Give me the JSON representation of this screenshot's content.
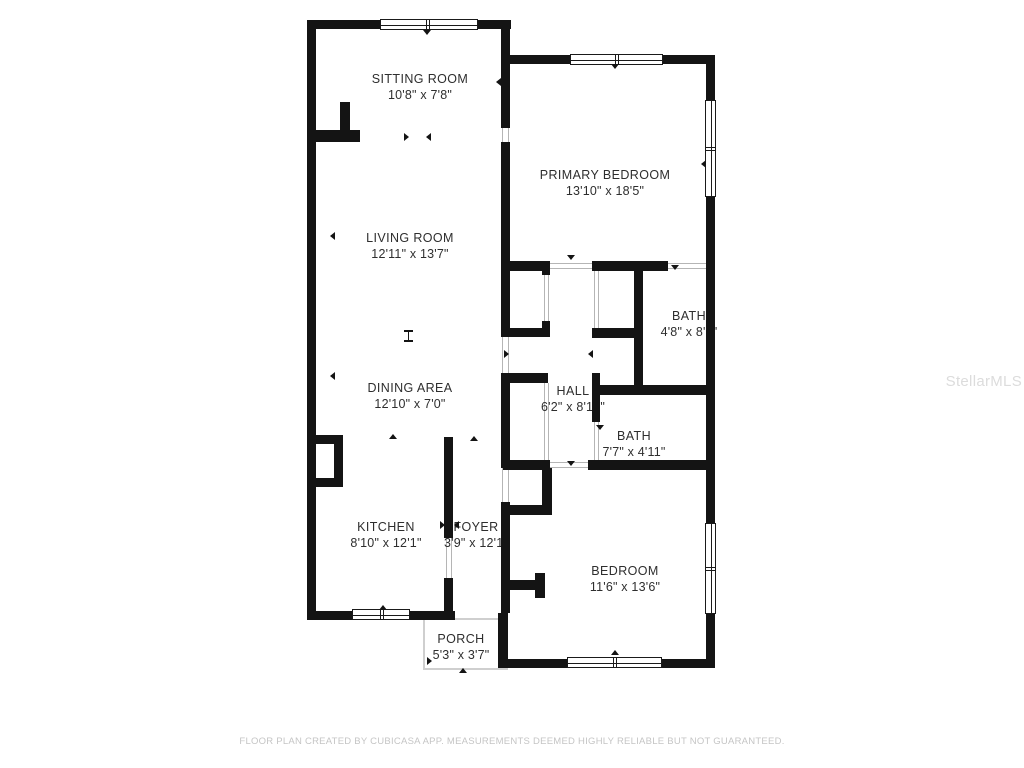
{
  "rooms": {
    "sitting_room": {
      "name": "SITTING ROOM",
      "dims": "10'8\" x 7'8\""
    },
    "primary_bedroom": {
      "name": "PRIMARY BEDROOM",
      "dims": "13'10\" x 18'5\""
    },
    "living_room": {
      "name": "LIVING ROOM",
      "dims": "12'11\" x 13'7\""
    },
    "bath_upper": {
      "name": "BATH",
      "dims": "4'8\" x 8'2\""
    },
    "hall": {
      "name": "HALL",
      "dims": "6'2\" x 8'10\""
    },
    "bath_lower": {
      "name": "BATH",
      "dims": "7'7\" x 4'11\""
    },
    "dining_area": {
      "name": "DINING AREA",
      "dims": "12'10\" x 7'0\""
    },
    "kitchen": {
      "name": "KITCHEN",
      "dims": "8'10\" x 12'1\""
    },
    "foyer": {
      "name": "FOYER",
      "dims": "3'9\" x 12'1\""
    },
    "bedroom": {
      "name": "BEDROOM",
      "dims": "11'6\" x 13'6\""
    },
    "porch": {
      "name": "PORCH",
      "dims": "5'3\" x 3'7\""
    }
  },
  "watermark": {
    "text": "StellarMLS"
  },
  "footer": {
    "disclaimer": "FLOOR PLAN CREATED BY CUBICASA APP. MEASUREMENTS DEEMED HIGHLY RELIABLE BUT NOT GUARANTEED."
  },
  "colors": {
    "wall": "#141414",
    "door_line": "#b5b5b5",
    "porch_outline": "#cfcfcf",
    "label_text": "#2e2e2e",
    "disclaimer_text": "#c5c5c5",
    "watermark_text": "#dcdcdc",
    "background": "#ffffff"
  }
}
